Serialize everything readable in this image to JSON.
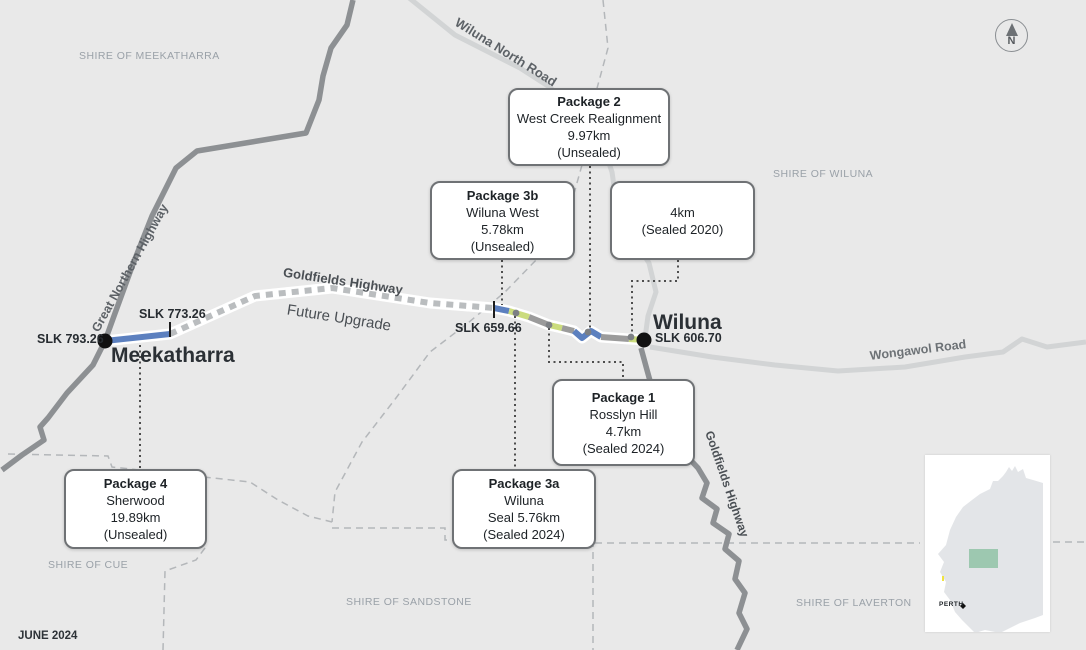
{
  "map_title_context": {
    "date_label": "JUNE 2024",
    "compass_label": "N"
  },
  "shires": {
    "meekatharra": "SHIRE OF MEEKATHARRA",
    "wiluna": "SHIRE OF WILUNA",
    "cue": "SHIRE OF CUE",
    "sandstone": "SHIRE OF SANDSTONE",
    "laverton": "SHIRE OF LAVERTON"
  },
  "towns": {
    "meekatharra": "Meekatharra",
    "wiluna": "Wiluna"
  },
  "slk_markers": {
    "meekatharra_town": "SLK 793.26",
    "sherwood_east": "SLK 773.26",
    "wiluna_west": "SLK 659.66",
    "wiluna_town": "SLK 606.70"
  },
  "road_labels": {
    "great_northern_highway": "Great Northern Highway",
    "wiluna_north_road": "Wiluna North Road",
    "goldfields_highway": "Goldfields Highway",
    "future_upgrade": "Future Upgrade",
    "wongawol_road": "Wongawol Road",
    "goldfields_highway_south": "Goldfields Highway"
  },
  "packages": [
    {
      "id": "package-2",
      "title": "Package 2",
      "lines": [
        "West Creek Realignment",
        "9.97km",
        "(Unsealed)"
      ]
    },
    {
      "id": "package-3b",
      "title": "Package 3b",
      "lines": [
        "Wiluna West",
        "5.78km",
        "(Unsealed)"
      ]
    },
    {
      "id": "sealed-2020",
      "title": "",
      "lines": [
        "4km",
        "(Sealed 2020)"
      ]
    },
    {
      "id": "package-1",
      "title": "Package 1",
      "lines": [
        "Rosslyn Hill",
        "4.7km",
        "(Sealed 2024)"
      ]
    },
    {
      "id": "package-4",
      "title": "Package 4",
      "lines": [
        "Sherwood",
        "19.89km",
        "(Unsealed)"
      ]
    },
    {
      "id": "package-3a",
      "title": "Package 3a",
      "lines": [
        "Wiluna",
        "Seal 5.76km",
        "(Sealed 2024)"
      ]
    }
  ],
  "inset": {
    "perth_label": "PERTH"
  },
  "colors": {
    "background": "#e9e9e9",
    "unsealed_package_blue": "#5c80bf",
    "sealed_2024_green": "#cbdc7d",
    "existing_road_gray": "#9b9b9b",
    "future_upgrade_dash": "#babdbf",
    "major_road": "#8d9093",
    "minor_road": "#d2d4d5",
    "inset_highlight": "#9dc8b0"
  }
}
